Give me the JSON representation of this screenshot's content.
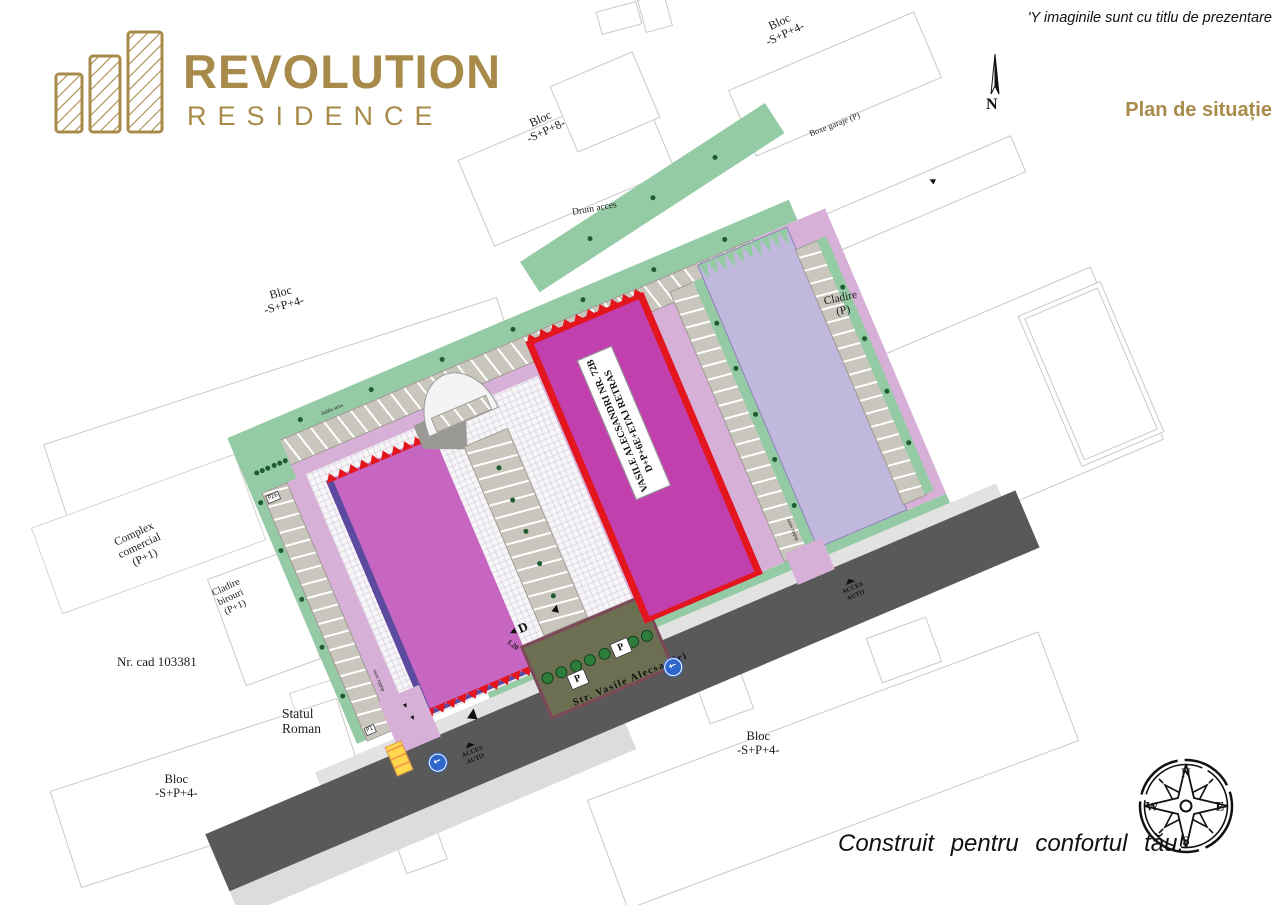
{
  "branding": {
    "title": "REVOLUTION",
    "subtitle": "RESIDENCE",
    "accent_color": "#a88b4a"
  },
  "header": {
    "disclaimer": "'Y imaginile sunt cu titlu de prezentare",
    "plan_title": "Plan de situație"
  },
  "north_indicator": {
    "label": "N"
  },
  "compass": {
    "north": "N",
    "east": "E",
    "south": "S",
    "west": "W"
  },
  "footer": {
    "slogan": "Construit  pentru  confortul  tău!"
  },
  "site": {
    "street_name": "Str. Vasile Alecsandri",
    "main_building_label": {
      "line1": "VASILE ALECSANDRI NR. 72B",
      "line2": "D+P+6E+ETAJ RETRAS"
    },
    "annotations": {
      "drum_acces": "Drum acces",
      "dublu_sens": "dublu sens",
      "acces_line1": "ACCES",
      "acces_line2": "AUTO",
      "d_marker": "D",
      "d_value": "1.20",
      "p_marker": "P"
    },
    "parking": {
      "first": "P1",
      "left_top": "P26",
      "top_start": "P27",
      "top_end": "P55"
    },
    "colors": {
      "gold": "#a88b4a",
      "magenta_left": "#c766c1",
      "magenta_right": "#c23fae",
      "purple_border": "#5a4aa0",
      "red_border": "#e3151d",
      "lavender": "#c1b8de",
      "site_pink": "#d7b0d7",
      "green": "#94cba4",
      "tree_green": "#1f5c31",
      "olive_parking": "#6d6f52",
      "road_gray": "#595959",
      "stall_gray": "#c9c6bd",
      "sign_blue": "#2f66cc",
      "stall_yellow": "#ffd84d"
    }
  },
  "surroundings": {
    "bloc_sp8": {
      "line1": "Bloc",
      "line2": "-S+P+8-"
    },
    "bloc_sp4": {
      "line1": "Bloc",
      "line2": "-S+P+4-"
    },
    "boxe_garaje": "Boxe garaje (P)",
    "cladire_p": {
      "line1": "Cladire",
      "line2": "(P)"
    },
    "complex_comercial": {
      "line1": "Complex",
      "line2": "comercial",
      "line3": "(P+1)"
    },
    "cladire_birouri": {
      "line1": "Cladire",
      "line2": "birouri",
      "line3": "(P+1)"
    },
    "nr_cad": "Nr. cad 103381",
    "statul_roman": {
      "line1": "Statul",
      "line2": "Roman"
    }
  },
  "icons": {
    "one_way": "←",
    "arrow": "▲",
    "left_triangle": "◀"
  }
}
